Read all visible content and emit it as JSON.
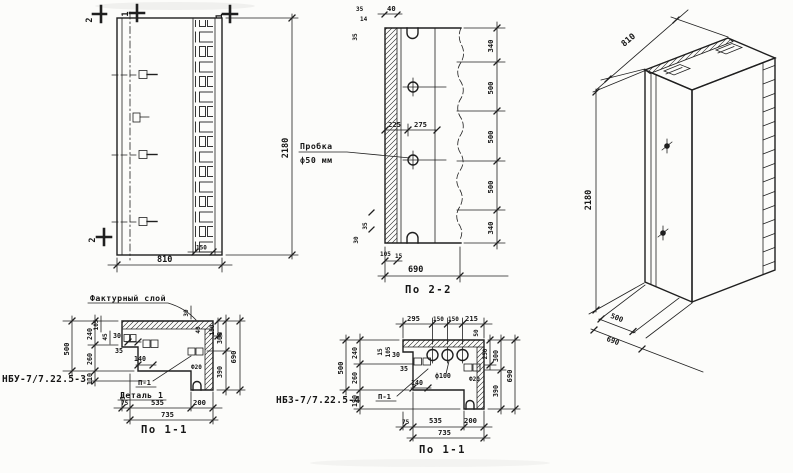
{
  "front": {
    "m2_top": "2",
    "m1_top": "1",
    "m1_right": "1",
    "m2_side": "2",
    "dim150": "150",
    "dim810": "810",
    "dim2180": "2180"
  },
  "section": {
    "t35": "35",
    "t14": "14",
    "t40": "40",
    "l35": "35",
    "callout1": "Пробка",
    "callout2": "ф50 мм",
    "d225": "225",
    "d275": "275",
    "chain": [
      "340",
      "500",
      "500",
      "500",
      "340"
    ],
    "b35": "35",
    "b30": "30",
    "d105": "105",
    "d15": "15",
    "d690": "690",
    "title": "По 2-2"
  },
  "axon": {
    "d810": "810",
    "d2180": "2180",
    "d500": "500",
    "d690": "690"
  },
  "plan3": {
    "mark": "НБУ-7/7.22.5-3",
    "facing": "Фактурный слой",
    "d500": "500",
    "d240": "240",
    "d260": "260",
    "d110": "110",
    "d105": "105",
    "d45": "45",
    "d30": "30",
    "d35": "35",
    "d140": "140",
    "r30": "30",
    "r40": "40",
    "r150": "150",
    "r300": "300",
    "r390": "390",
    "r690": "690",
    "f20": "Ф20",
    "p1": "П-1",
    "detail": "Деталь 1",
    "b75": "75",
    "b535": "535",
    "b200": "200",
    "b735": "735",
    "title": "По 1-1"
  },
  "plan4": {
    "mark": "НБЗ-7/7.22.5-4",
    "t295": "295",
    "t150a": "150",
    "t150b": "150",
    "t215": "215",
    "r50": "50",
    "d500": "500",
    "d240": "240",
    "d260": "260",
    "d190": "190",
    "s15": "15",
    "s105": "105",
    "s30": "30",
    "s35": "35",
    "s140": "140",
    "f100": "ф100",
    "f20": "Ф20",
    "r250": "250",
    "r300": "300",
    "r390": "390",
    "r690": "690",
    "p1": "П-1",
    "b75": "75",
    "b535": "535",
    "b200": "200",
    "b735": "735",
    "title": "По 1-1"
  },
  "colors": {
    "ink": "#1f1f1f",
    "paper": "#fcfcfa"
  }
}
